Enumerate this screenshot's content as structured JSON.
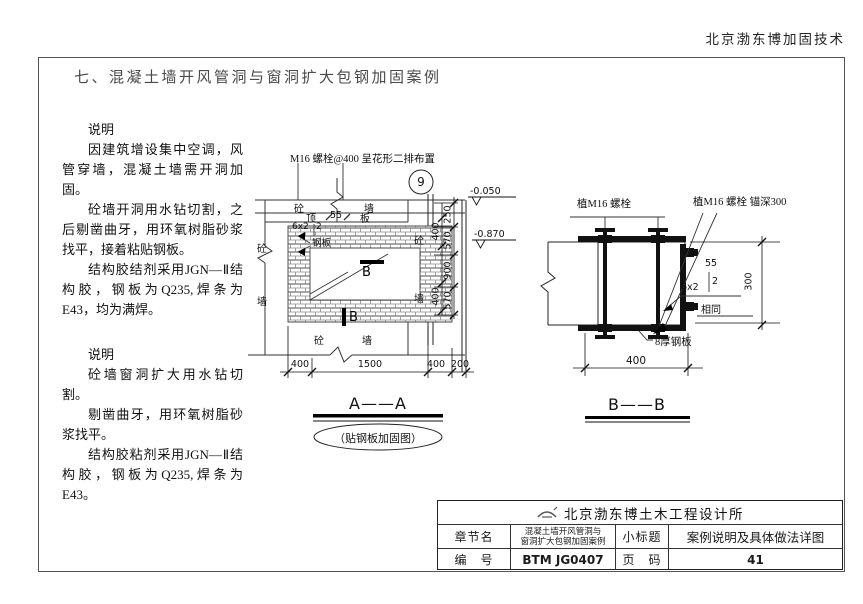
{
  "header": {
    "brand": "北京渤东博加固技术"
  },
  "page_title": "七、混凝土墙开风管洞与窗洞扩大包钢加固案例",
  "notes_block1": {
    "heading": "说明",
    "p1": "因建筑增设集中空调，风管穿墙，混凝土墙需开洞加固。",
    "p2": "砼墙开洞用水钻切割，之后剔凿曲牙，用环氧树脂砂浆找平，接着粘贴钢板。",
    "p3": "结构胶结剂采用JGN—Ⅱ结构胶，钢板为Q235,焊条为E43，均为满焊。"
  },
  "notes_block2": {
    "heading": "说明",
    "p1": "砼墙窗洞扩大用水钻切割。",
    "p2": "剔凿曲牙，用环氧树脂砂浆找平。",
    "p3": "结构胶粘剂采用JGN—Ⅱ结构胶，钢板为Q235,焊条为E43。"
  },
  "drawing_a": {
    "top_note": "M16 螺栓@400 呈花形二排布置",
    "grid_bubble": "9",
    "band_concrete": "砼",
    "band_wall": "墙",
    "slab_left": "顶",
    "slab_dim": "55",
    "slab_right": "板",
    "weld_spec": "6x2",
    "weld_count": "2",
    "plate_label": "钢板",
    "section_mark_top": "B",
    "section_mark_bottom": "B",
    "left_concrete": "砼",
    "left_wall": "墙",
    "right_concrete": "砼",
    "right_wall": "墙",
    "bottom_concrete": "砼",
    "bottom_wall": "墙",
    "elev_top": "-0.050",
    "elev_mid": "-0.870",
    "dim_col1_a": "400",
    "dim_col1_b": "400",
    "dim_col2_a": "250",
    "dim_col2_b": "570",
    "dim_col2_c": "900",
    "dim_col2_d": "570",
    "dim_bot_a": "400",
    "dim_bot_b": "1500",
    "dim_bot_c": "400",
    "dim_bot_d": "200",
    "title": "A——A",
    "subtitle": "（贴钢板加固图）"
  },
  "drawing_b": {
    "anchor_note_left": "植M16 螺栓",
    "anchor_note_right": "植M16 螺栓 锚深300",
    "weld_len": "55",
    "weld_count": "2",
    "weld_spec": "6x2",
    "weld_same": "相同",
    "dim_right": "300",
    "plate_note": "8厚钢板",
    "dim_bottom": "400",
    "title": "B——B"
  },
  "title_block": {
    "company": "北京渤东博土木工程设计所",
    "chapter_label": "章节名",
    "chapter_line1": "混凝土墙开风管洞与",
    "chapter_line2": "窗洞扩大包钢加固案例",
    "subtitle_label": "小标题",
    "subtitle_value": "案例说明及具体做法详图",
    "number_label": "编　号",
    "number_value": "BTM JG0407",
    "pagenum_label": "页　码",
    "pagenum_value": "41"
  }
}
